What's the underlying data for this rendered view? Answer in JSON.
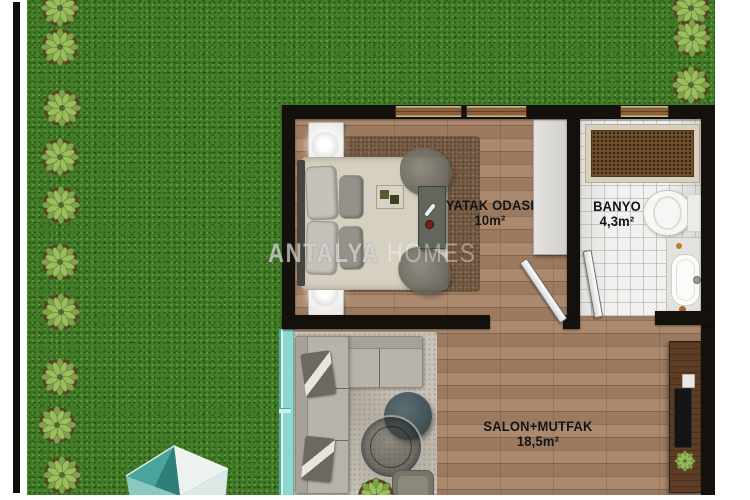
{
  "watermark": {
    "primary": "ANTALYA",
    "secondary": "HOMES"
  },
  "rooms": {
    "bedroom": {
      "name": "YATAK ODASI",
      "area": "10m²"
    },
    "bathroom": {
      "name": "BANYO",
      "area": "4,3m²"
    },
    "living_kitchen": {
      "name": "SALON+MUTFAK",
      "area": "18,5m²"
    }
  },
  "garden": {
    "left_plant_count": 10,
    "right_plant_count": 3
  },
  "colors": {
    "grass": "#417c28",
    "wall": "#14100c",
    "wood_floor": "#a58266",
    "bathroom_tile": "#f1f1ef",
    "glass_door": "#8fd8d2",
    "structure_teal": "#3d9a93"
  }
}
